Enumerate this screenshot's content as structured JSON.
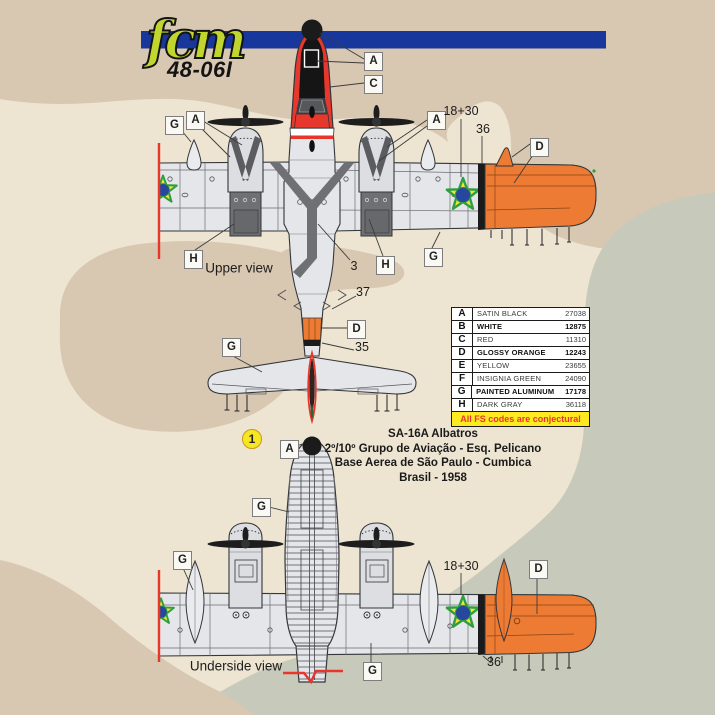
{
  "sheet": {
    "brand": "fcm",
    "product_code": "48-06I",
    "scheme_number": "1",
    "subject_lines": [
      "SA-16A Albatros",
      "2º/10º Grupo de Aviação - Esq. Pelicano",
      "Base Aerea de São Paulo - Cumbica",
      "Brasil - 1958"
    ]
  },
  "views": {
    "upper": {
      "caption": "Upper view"
    },
    "underside": {
      "caption": "Underside view"
    }
  },
  "color_table": {
    "rows": [
      {
        "code": "A",
        "name": "SATIN BLACK",
        "fs": "27038",
        "bold": false
      },
      {
        "code": "B",
        "name": "WHITE",
        "fs": "12875",
        "bold": true
      },
      {
        "code": "C",
        "name": "RED",
        "fs": "11310",
        "bold": false
      },
      {
        "code": "D",
        "name": "GLOSSY ORANGE",
        "fs": "12243",
        "bold": true
      },
      {
        "code": "E",
        "name": "YELLOW",
        "fs": "23655",
        "bold": false
      },
      {
        "code": "F",
        "name": "INSIGNIA GREEN",
        "fs": "24090",
        "bold": false
      },
      {
        "code": "G",
        "name": "PAINTED ALUMINUM",
        "fs": "17178",
        "bold": true
      },
      {
        "code": "H",
        "name": "DARK GRAY",
        "fs": "36118",
        "bold": false
      }
    ],
    "footnote": "All FS codes are conjectural"
  },
  "callouts": [
    {
      "label": "A",
      "x": 364,
      "y": 52
    },
    {
      "label": "C",
      "x": 364,
      "y": 75
    },
    {
      "label": "G",
      "x": 165,
      "y": 116
    },
    {
      "label": "A",
      "x": 186,
      "y": 111
    },
    {
      "label": "A",
      "x": 427,
      "y": 111
    },
    {
      "label": "D",
      "x": 530,
      "y": 138
    },
    {
      "label": "H",
      "x": 184,
      "y": 250
    },
    {
      "label": "H",
      "x": 376,
      "y": 256
    },
    {
      "label": "G",
      "x": 424,
      "y": 248
    },
    {
      "label": "D",
      "x": 347,
      "y": 320
    },
    {
      "label": "G",
      "x": 222,
      "y": 338
    },
    {
      "label": "A",
      "x": 280,
      "y": 440
    },
    {
      "label": "G",
      "x": 252,
      "y": 498
    },
    {
      "label": "G",
      "x": 173,
      "y": 551
    },
    {
      "label": "D",
      "x": 529,
      "y": 560
    },
    {
      "label": "G",
      "x": 363,
      "y": 662
    }
  ],
  "stencil_numbers": [
    {
      "text": "18+30",
      "x": 461,
      "y": 111
    },
    {
      "text": "36",
      "x": 483,
      "y": 129
    },
    {
      "text": "3",
      "x": 354,
      "y": 266
    },
    {
      "text": "37",
      "x": 363,
      "y": 292
    },
    {
      "text": "35",
      "x": 362,
      "y": 347
    },
    {
      "text": "18+30",
      "x": 461,
      "y": 566
    },
    {
      "text": "36",
      "x": 494,
      "y": 662
    }
  ],
  "palette": {
    "banner_blue": "#17379C",
    "logo_green": "#C0D62F",
    "paper_beige": "#EDE4D1",
    "camo_tan": "#D8C7B1",
    "camo_green": "#C7CABA",
    "aluminum": "#E4E6EA",
    "red": "#E8372C",
    "glossy_orange": "#EE7B33",
    "satin_black": "#1B1B1B",
    "dark_gray": "#6E7074",
    "roundel_blue": "#27479E",
    "roundel_green": "#2E9E41",
    "roundel_yellow": "#F0E53C",
    "footnote_yellow": "#FFE920",
    "footnote_red": "#E8362B"
  }
}
